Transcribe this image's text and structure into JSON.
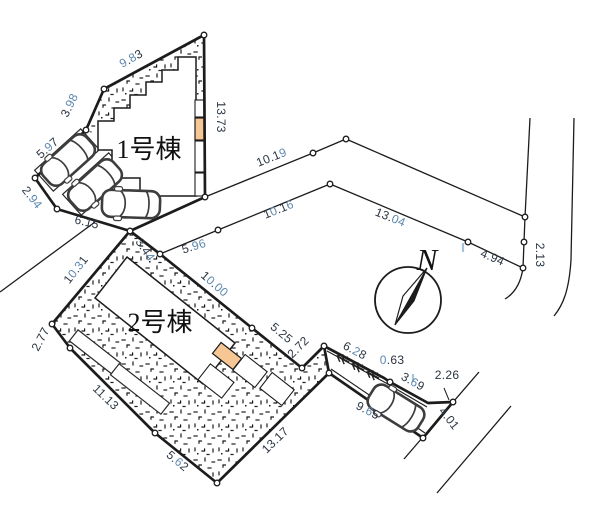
{
  "labels": {
    "building1": "1号棟",
    "building2": "2号棟",
    "north": "N"
  },
  "colors": {
    "ink": "#1c1c1c",
    "dim_dark": "#2b3442",
    "dim_blue": "#5e87ad",
    "entrance_orange": "#f6c694",
    "scan_tick_blue": "#a5c4dc",
    "paper": "#ffffff"
  },
  "dimensions": [
    {
      "v": "9.83",
      "x": 133,
      "y": 62,
      "r": -29,
      "blue": [
        0,
        2
      ]
    },
    {
      "v": "3.98",
      "x": 73,
      "y": 107,
      "r": -64,
      "blue": [
        2,
        3
      ]
    },
    {
      "v": "5.97",
      "x": 50,
      "y": 151,
      "r": -41,
      "blue": [
        2
      ]
    },
    {
      "v": "2.94",
      "x": 29,
      "y": 200,
      "r": 52,
      "blue": [
        2,
        3
      ]
    },
    {
      "v": "6.15",
      "x": 86,
      "y": 226,
      "r": 13,
      "blue": []
    },
    {
      "v": "13.73",
      "x": 217,
      "y": 117,
      "r": 90,
      "blue": []
    },
    {
      "v": "10.19",
      "x": 273,
      "y": 161,
      "r": -22,
      "blue": [
        4
      ]
    },
    {
      "v": "10.16",
      "x": 280,
      "y": 213,
      "r": -22,
      "blue": [
        1,
        4
      ]
    },
    {
      "v": "5.96",
      "x": 195,
      "y": 250,
      "r": -17,
      "blue": [
        2,
        3
      ]
    },
    {
      "v": "13.04",
      "x": 389,
      "y": 221,
      "r": 22,
      "blue": [
        3,
        4
      ]
    },
    {
      "v": "4.94",
      "x": 491,
      "y": 261,
      "r": 23,
      "blue": []
    },
    {
      "v": "2.13",
      "x": 536,
      "y": 255,
      "r": 90,
      "blue": []
    },
    {
      "v": "3.44",
      "x": 142,
      "y": 252,
      "r": 55,
      "blue": [
        3
      ]
    },
    {
      "v": "10.00",
      "x": 212,
      "y": 287,
      "r": 41,
      "blue": [
        1,
        3,
        4
      ]
    },
    {
      "v": "5.25",
      "x": 279,
      "y": 336,
      "r": 40,
      "blue": []
    },
    {
      "v": "2.72",
      "x": 301,
      "y": 350,
      "r": -45,
      "blue": []
    },
    {
      "v": "6.28",
      "x": 353,
      "y": 354,
      "r": 28,
      "blue": [
        2
      ]
    },
    {
      "v": "0.63",
      "x": 392,
      "y": 364,
      "r": 0,
      "blue": [
        0
      ]
    },
    {
      "v": "3.69",
      "x": 411,
      "y": 385,
      "r": 29,
      "blue": [
        2
      ]
    },
    {
      "v": "2.26",
      "x": 447,
      "y": 379,
      "r": 0,
      "blue": []
    },
    {
      "v": "9.65",
      "x": 366,
      "y": 414,
      "r": 28,
      "blue": [
        2
      ]
    },
    {
      "v": "4.01",
      "x": 446,
      "y": 421,
      "r": 52,
      "blue": []
    },
    {
      "v": "10.31",
      "x": 79,
      "y": 272,
      "r": -52,
      "blue": [
        1,
        3
      ]
    },
    {
      "v": "2.77",
      "x": 44,
      "y": 341,
      "r": -62,
      "blue": []
    },
    {
      "v": "11.13",
      "x": 103,
      "y": 400,
      "r": 44,
      "blue": []
    },
    {
      "v": "5.62",
      "x": 175,
      "y": 464,
      "r": 40,
      "blue": [
        2
      ]
    },
    {
      "v": "13.17",
      "x": 278,
      "y": 443,
      "r": -44,
      "blue": []
    }
  ]
}
